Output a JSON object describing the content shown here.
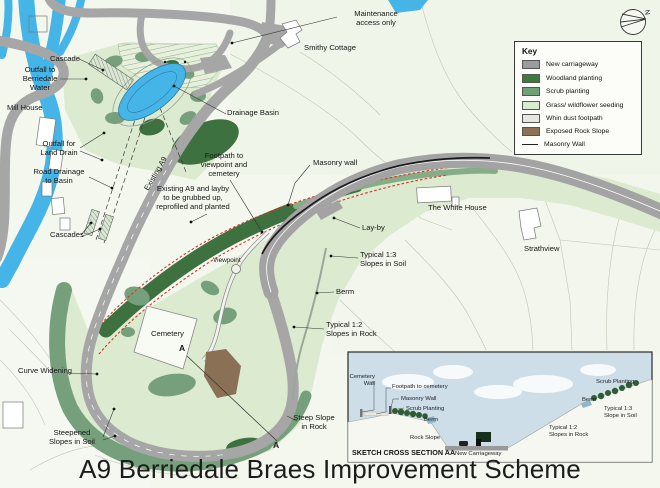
{
  "title": "A9 Berriedale Braes Improvement Scheme",
  "map": {
    "north_label": "N",
    "labels": {
      "maintenance": "Maintenance\naccess only",
      "cascade": "Cascade",
      "outfall_berriedale": "Outfall to\nBerriedale\nWater",
      "mill_house": "Mill House",
      "outfall_land_drain": "Outfall for\nLand Drain",
      "road_drainage": "Road Drainage\nto Basin",
      "cascades": "Cascades",
      "smithy_cottage": "Smithy Cottage",
      "drainage_basin": "Drainage Basin",
      "existing_a9": "Existing A9",
      "footpath": "Footpath to\nviewpoint and\ncemetery",
      "masonry_wall": "Masonry wall",
      "grubbed": "Existing A9 and layby\nto be grubbed up,\nreprofiled and planted",
      "layby": "Lay-by",
      "white_house": "The White House",
      "strathview": "Strathview",
      "slopes_1_3": "Typical 1:3\nSlopes in Soil",
      "berm": "Berm",
      "slopes_1_2": "Typical 1:2\nSlopes in Rock",
      "cemetery": "Cemetery",
      "curve_widening": "Curve Widening",
      "steepened_slopes": "Steepened\nSlopes in Soil",
      "steep_slope": "Steep Slope\nin Rock",
      "viewpoint": "Viewpoint",
      "section_a_top": "A",
      "section_a_bottom": "A"
    }
  },
  "key": {
    "title": "Key",
    "items": [
      {
        "label": "New carriageway",
        "color": "#9c9c9c"
      },
      {
        "label": "Woodland planting",
        "color": "#3d7a3d"
      },
      {
        "label": "Scrub planting",
        "color": "#6fa077"
      },
      {
        "label": "Grass/ wildflower seeding",
        "color": "#d9ecd0"
      },
      {
        "label": "Whin dust footpath",
        "color": "#e6e6e2"
      },
      {
        "label": "Exposed Rock Slope",
        "color": "#8a7158"
      },
      {
        "label": "Masonry Wall",
        "color": "#222222"
      }
    ]
  },
  "cross_section": {
    "title": "SKETCH CROSS SECTION AA",
    "labels": {
      "cemetery_wall": "Cemetery\nWall",
      "footpath_to_cemetery": "Footpath to cemetery",
      "masonry_wall": "Masonry Wall",
      "scrub_planting_left": "Scrub Planting",
      "berm_left": "Berm",
      "rock_slope": "Rock Slope",
      "new_carriageway": "New Carriageway",
      "slopes_1_2": "Typical 1:2\nSlopes in Rock",
      "berm_right": "Berm",
      "scrub_planting_right": "Scrub Planting",
      "slope_1_3": "Typical 1:3\nSlope in Soil"
    }
  },
  "colors": {
    "river_blue": "#45b5e8",
    "road_grey": "#a6a6a6",
    "grass_seeding": "#dcead0",
    "woodland": "#3e7140",
    "scrub": "#76a07c",
    "rock_brown": "#8a7055",
    "red_dashed_old_a9": "#e03222",
    "sky": "#cddee9",
    "field_background": "#f3f7ee"
  }
}
